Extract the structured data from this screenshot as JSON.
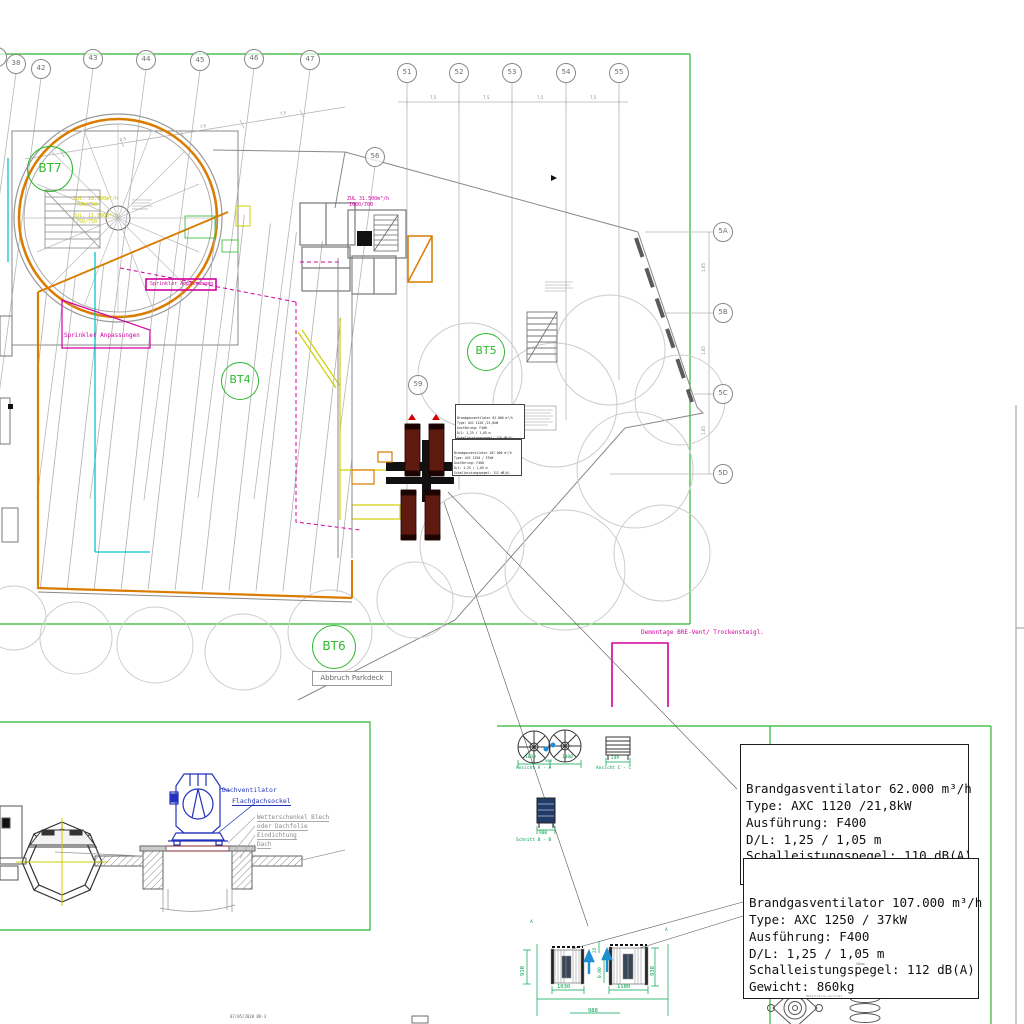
{
  "colors": {
    "frame_green": "#2db82d",
    "dim_green": "#00a050",
    "orange": "#d97c00",
    "magenta": "#d4009e",
    "cyan": "#00c8c8",
    "yellow": "#cfcf00",
    "maroon": "#5e1a0e",
    "blue": "#2233bb",
    "arrow_blue": "#1e8fd5"
  },
  "grid": {
    "chain_label": "7,5",
    "row_chain_label": "1,65",
    "top_left": [
      {
        "label": "1",
        "x": -3,
        "y": 57
      },
      {
        "label": "38",
        "x": 16,
        "y": 64
      },
      {
        "label": "42",
        "x": 41,
        "y": 69
      },
      {
        "label": "43",
        "x": 93,
        "y": 59
      },
      {
        "label": "44",
        "x": 146,
        "y": 60
      },
      {
        "label": "45",
        "x": 200,
        "y": 61
      },
      {
        "label": "46",
        "x": 254,
        "y": 59
      },
      {
        "label": "47",
        "x": 310,
        "y": 60
      }
    ],
    "top_right": [
      {
        "label": "51",
        "x": 407,
        "y": 73
      },
      {
        "label": "52",
        "x": 459,
        "y": 73
      },
      {
        "label": "53",
        "x": 512,
        "y": 73
      },
      {
        "label": "54",
        "x": 566,
        "y": 73
      },
      {
        "label": "55",
        "x": 619,
        "y": 73
      }
    ],
    "mid": [
      {
        "label": "56",
        "x": 375,
        "y": 157
      },
      {
        "label": "59",
        "x": 418,
        "y": 385
      }
    ],
    "right": [
      {
        "label": "5A",
        "x": 723,
        "y": 232
      },
      {
        "label": "5B",
        "x": 723,
        "y": 313
      },
      {
        "label": "5C",
        "x": 723,
        "y": 394
      },
      {
        "label": "5D",
        "x": 723,
        "y": 474
      }
    ]
  },
  "bt": [
    {
      "label": "BT7",
      "x": 50,
      "y": 169,
      "d": 44,
      "fs": 12
    },
    {
      "label": "BT4",
      "x": 240,
      "y": 381,
      "d": 36,
      "fs": 11
    },
    {
      "label": "BT5",
      "x": 486,
      "y": 352,
      "d": 36,
      "fs": 11
    },
    {
      "label": "BT6",
      "x": 334,
      "y": 647,
      "d": 42,
      "fs": 12
    }
  ],
  "plan_texts": {
    "abbruch": "Abbruch Parkdeck",
    "demontage": "Demontage BRE-Vent/ Trockensteigl.",
    "sprinkler1": "Sprinkler Anpassungen",
    "sprinkler2": "Sprinkler Anpassungen",
    "zul1": "Zul. 18.500m³/h",
    "zul1b": "750/750",
    "zul2": "Zul. 11.800m³/h",
    "zul2b": "750/750",
    "zul3": "ZUL 31.500m³/h",
    "zul3b": "1000/700"
  },
  "detail": {
    "fan_label": "Dachventilator",
    "base_label": "Flachdachsockel",
    "roof_labels": [
      {
        "label": "Wetterschenkel Blech",
        "x": 257,
        "y": 814
      },
      {
        "label": "oder Dachfolie",
        "x": 257,
        "y": 823
      },
      {
        "label": "Eindichtung",
        "x": 257,
        "y": 832
      },
      {
        "label": "Dach",
        "x": 257,
        "y": 841
      }
    ]
  },
  "spec_boxes": [
    {
      "lines": [
        {
          "t": "Brandgasventilator 62.000 m³/h"
        },
        {
          "t": "Type: AXC 1120 /21,8kW"
        },
        {
          "t": "Ausführung: F400"
        },
        {
          "t": "D/L: 1,25 / 1,05 m"
        },
        {
          "t": "Schalleistungspegel: 110 dB(A)"
        },
        {
          "t": "Gewicht: 549kg"
        }
      ]
    },
    {
      "lines": [
        {
          "t": "Brandgasventilator 107.000 m³/h"
        },
        {
          "t": "Type: AXC 1250 / 37kW"
        },
        {
          "t": "Ausführung: F400"
        },
        {
          "t": "D/L: 1,25 / 1,05 m"
        },
        {
          "t": "Schalleistungspegel: 112 dB(A)"
        },
        {
          "t": "Gewicht: 860kg"
        }
      ]
    }
  ],
  "views": {
    "aa_caption": "Ansicht A - A",
    "aa_dim1": "1030",
    "aa_gap": "988",
    "aa_dim2": "1100",
    "cc_caption": "Ansicht C - C",
    "cc_dim": "249",
    "bb_caption": "Schnitt B - B",
    "bb_dim": "900"
  },
  "sections": {
    "marker": "A",
    "h_left": "910",
    "w_left": "1030",
    "h_right": "938",
    "w_right": "1180",
    "gap": "25",
    "zero": "0,00",
    "span": "988"
  },
  "mounts": {
    "note": "Metallteile verzinkt",
    "dim": "50mm"
  },
  "revision": {
    "rows": [
      {
        "c0": "b",
        "c1": "neue Arch. ausgelegt",
        "c2": "VOB",
        "c3": "18.04.2022"
      },
      {
        "c0": "a",
        "c1": "Erstellung",
        "c2": "B.S",
        "c3": "21.10.2020"
      },
      {
        "c0": "Index",
        "c1": "Änderungen",
        "c2": "Name",
        "c3": "Datum"
      }
    ],
    "caption": "07/05/2020 BO-3"
  }
}
